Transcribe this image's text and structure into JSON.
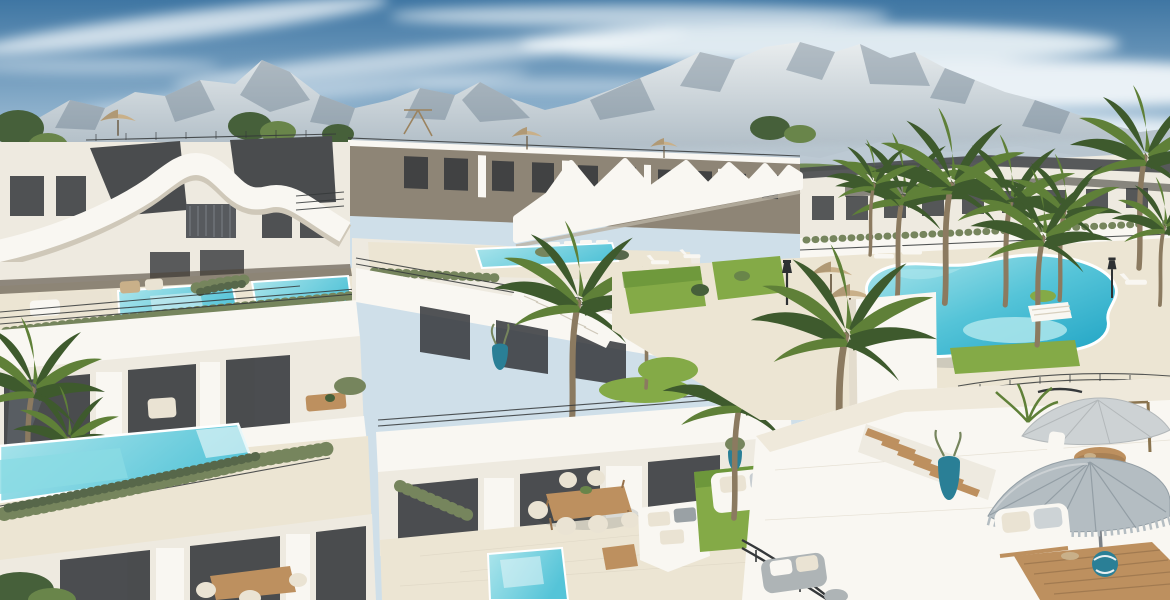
{
  "scene": {
    "description": "Aerial 3D architectural rendering of a white Mediterranean apartment complex: wavy zigzag white rooflines over taupe penthouse levels, stepped terraces with private turquoise plunge pools, a large free-form community pool surrounded by palm trees, rooftop lounge decks with gray fringed parasols, daybeds and wooden dining sets, green lawns and hedge planters, all beneath a rocky gray mountain range and a blue sky streaked with clouds."
  },
  "colors": {
    "sky_top": "#3f76a3",
    "sky_mid": "#8fb2cd",
    "sky_low": "#dde9f0",
    "cloud": "#f6fafc",
    "mountain_hi": "#e9edee",
    "mountain_lo": "#90a2b0",
    "mountain_shadow": "#5d7284",
    "mountain_haze": "#bcc9d3",
    "tree_dark": "#46603a",
    "tree_mid": "#69854a",
    "white_hi": "#f9f7f2",
    "white_mid": "#eeeae0",
    "white_lo": "#dcd5c6",
    "cream": "#ece5d3",
    "taupe": "#8e8576",
    "roof_dark": "#4a4c4e",
    "glass": "#34373b",
    "glass_warm": "#4e4438",
    "pool_hi": "#aee6ec",
    "pool_mid": "#55c4d8",
    "pool_lo": "#1ea3c4",
    "lawn": "#84aa47",
    "lawn_dark": "#5e8a33",
    "hedge": "#76855d",
    "hedge_dark": "#57674a",
    "palm_dark": "#3e5a2d",
    "palm_mid": "#5f8038",
    "palm_lite": "#86a84e",
    "trunk": "#8b7a60",
    "wood": "#bd905f",
    "wood_dark": "#96714b",
    "parasol_hi": "#cdd2d4",
    "parasol": "#b4bdc2",
    "parasol_lo": "#939ea5",
    "cushion": "#eae3d3",
    "railing": "#35383a",
    "pot_teal": "#2a7f96",
    "tan": "#c9b089"
  }
}
